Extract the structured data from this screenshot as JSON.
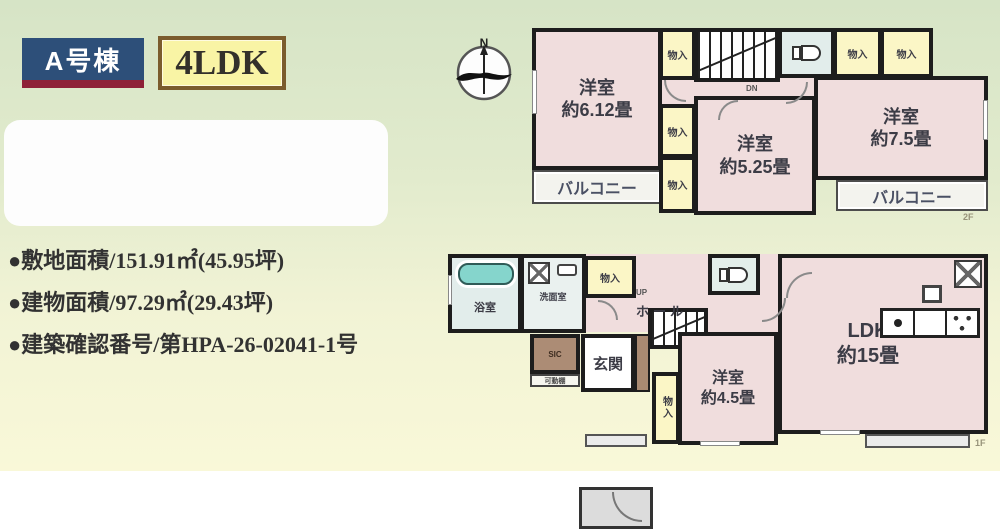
{
  "header": {
    "building_label": "A号棟",
    "layout_label": "4LDK",
    "building_bg": "#2d4f79",
    "building_accent": "#8e2138",
    "layout_bg": "#f9f4a5",
    "layout_border": "#7b5c2d"
  },
  "details": {
    "items": [
      "●敷地面積/151.91㎡(45.95坪)",
      "●建物面積/97.29㎡(29.43坪)",
      "●建築確認番号/第HPA-26-02041-1号"
    ]
  },
  "compass": {
    "north_label": "N"
  },
  "colors": {
    "room_pink": "#f0dddd",
    "closet_yellow": "#fbf6c6",
    "sanitary_blue": "#e2edeb",
    "bathtub_teal": "#85d5cc",
    "sic_brown": "#ac8c75",
    "wall_black": "#1d1d1d",
    "background_green": "#d6e4c6",
    "background_yellow": "#f9f8d8"
  },
  "floor2": {
    "label": "2F",
    "bedroom_left": "洋室\n約6.12畳",
    "bedroom_center": "洋室\n約5.25畳",
    "bedroom_right": "洋室\n約7.5畳",
    "balcony_left": "バルコニー",
    "balcony_right": "バルコニー",
    "closet": "物入",
    "stairs_down": "DN"
  },
  "floor1": {
    "label": "1F",
    "bath": "浴室",
    "washroom": "洗面室",
    "hall": "ホール",
    "closet": "物入",
    "stairs_up": "UP",
    "entrance": "玄関",
    "sic": "SIC",
    "shelf": "可動棚",
    "closet_vertical": "物入",
    "bedroom": "洋室\n約4.5畳",
    "ldk": "LDK\n約15畳"
  }
}
